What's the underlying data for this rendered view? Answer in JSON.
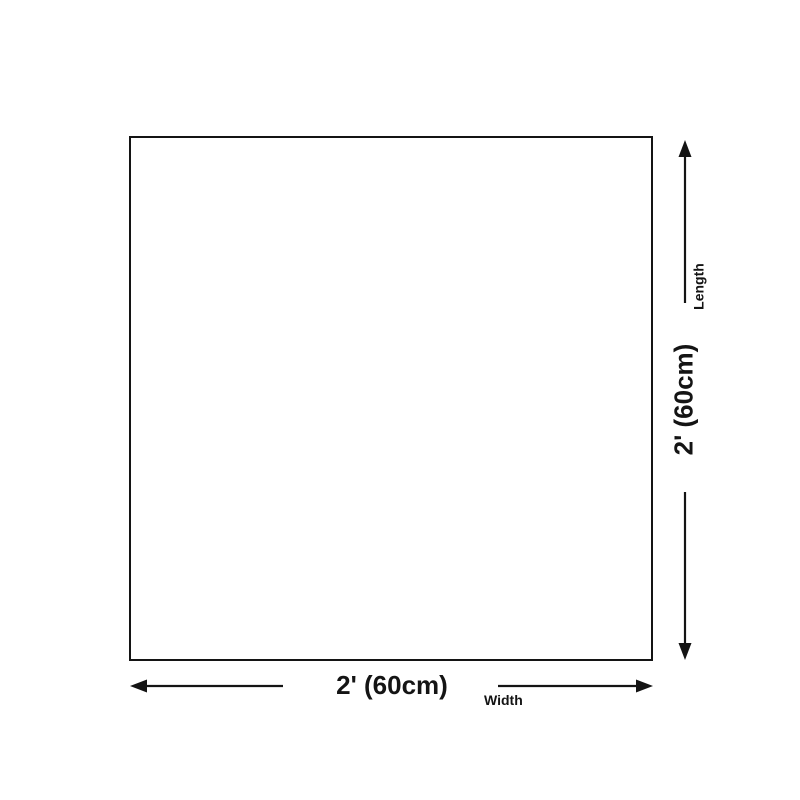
{
  "diagram": {
    "background_color": "#ffffff",
    "line_color": "#141414",
    "text_color": "#141414",
    "shape": "square-outline",
    "dimensions": {
      "width": {
        "value": "2' (60cm)",
        "label": "Width"
      },
      "length": {
        "value": "2' (60cm)",
        "label": "Length"
      }
    }
  }
}
